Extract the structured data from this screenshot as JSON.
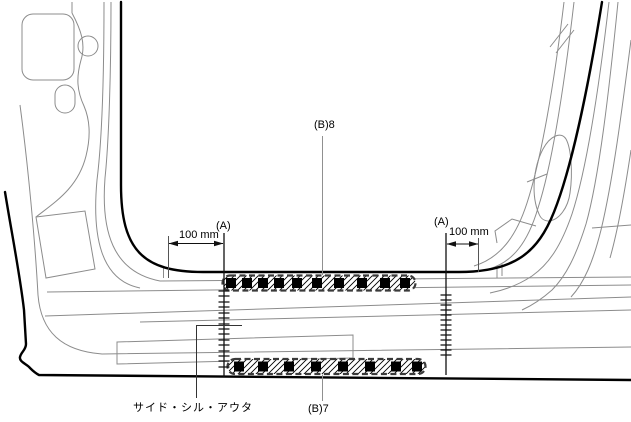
{
  "diagram": {
    "type": "vehicle-body-side-sill-weld-diagram",
    "labels": {
      "weld_spec_top": "(B)8",
      "weld_spec_bottom": "(B)7",
      "part_name": "サイド・シル・アウタ",
      "section_ref_left": "(A)",
      "section_ref_right": "(A)",
      "dimension_left": "100 mm",
      "dimension_right": "100 mm"
    },
    "colors": {
      "background": "#ffffff",
      "outline": "#000000",
      "thin_line": "#8c8c8c",
      "weld_marker": "#000000"
    }
  }
}
